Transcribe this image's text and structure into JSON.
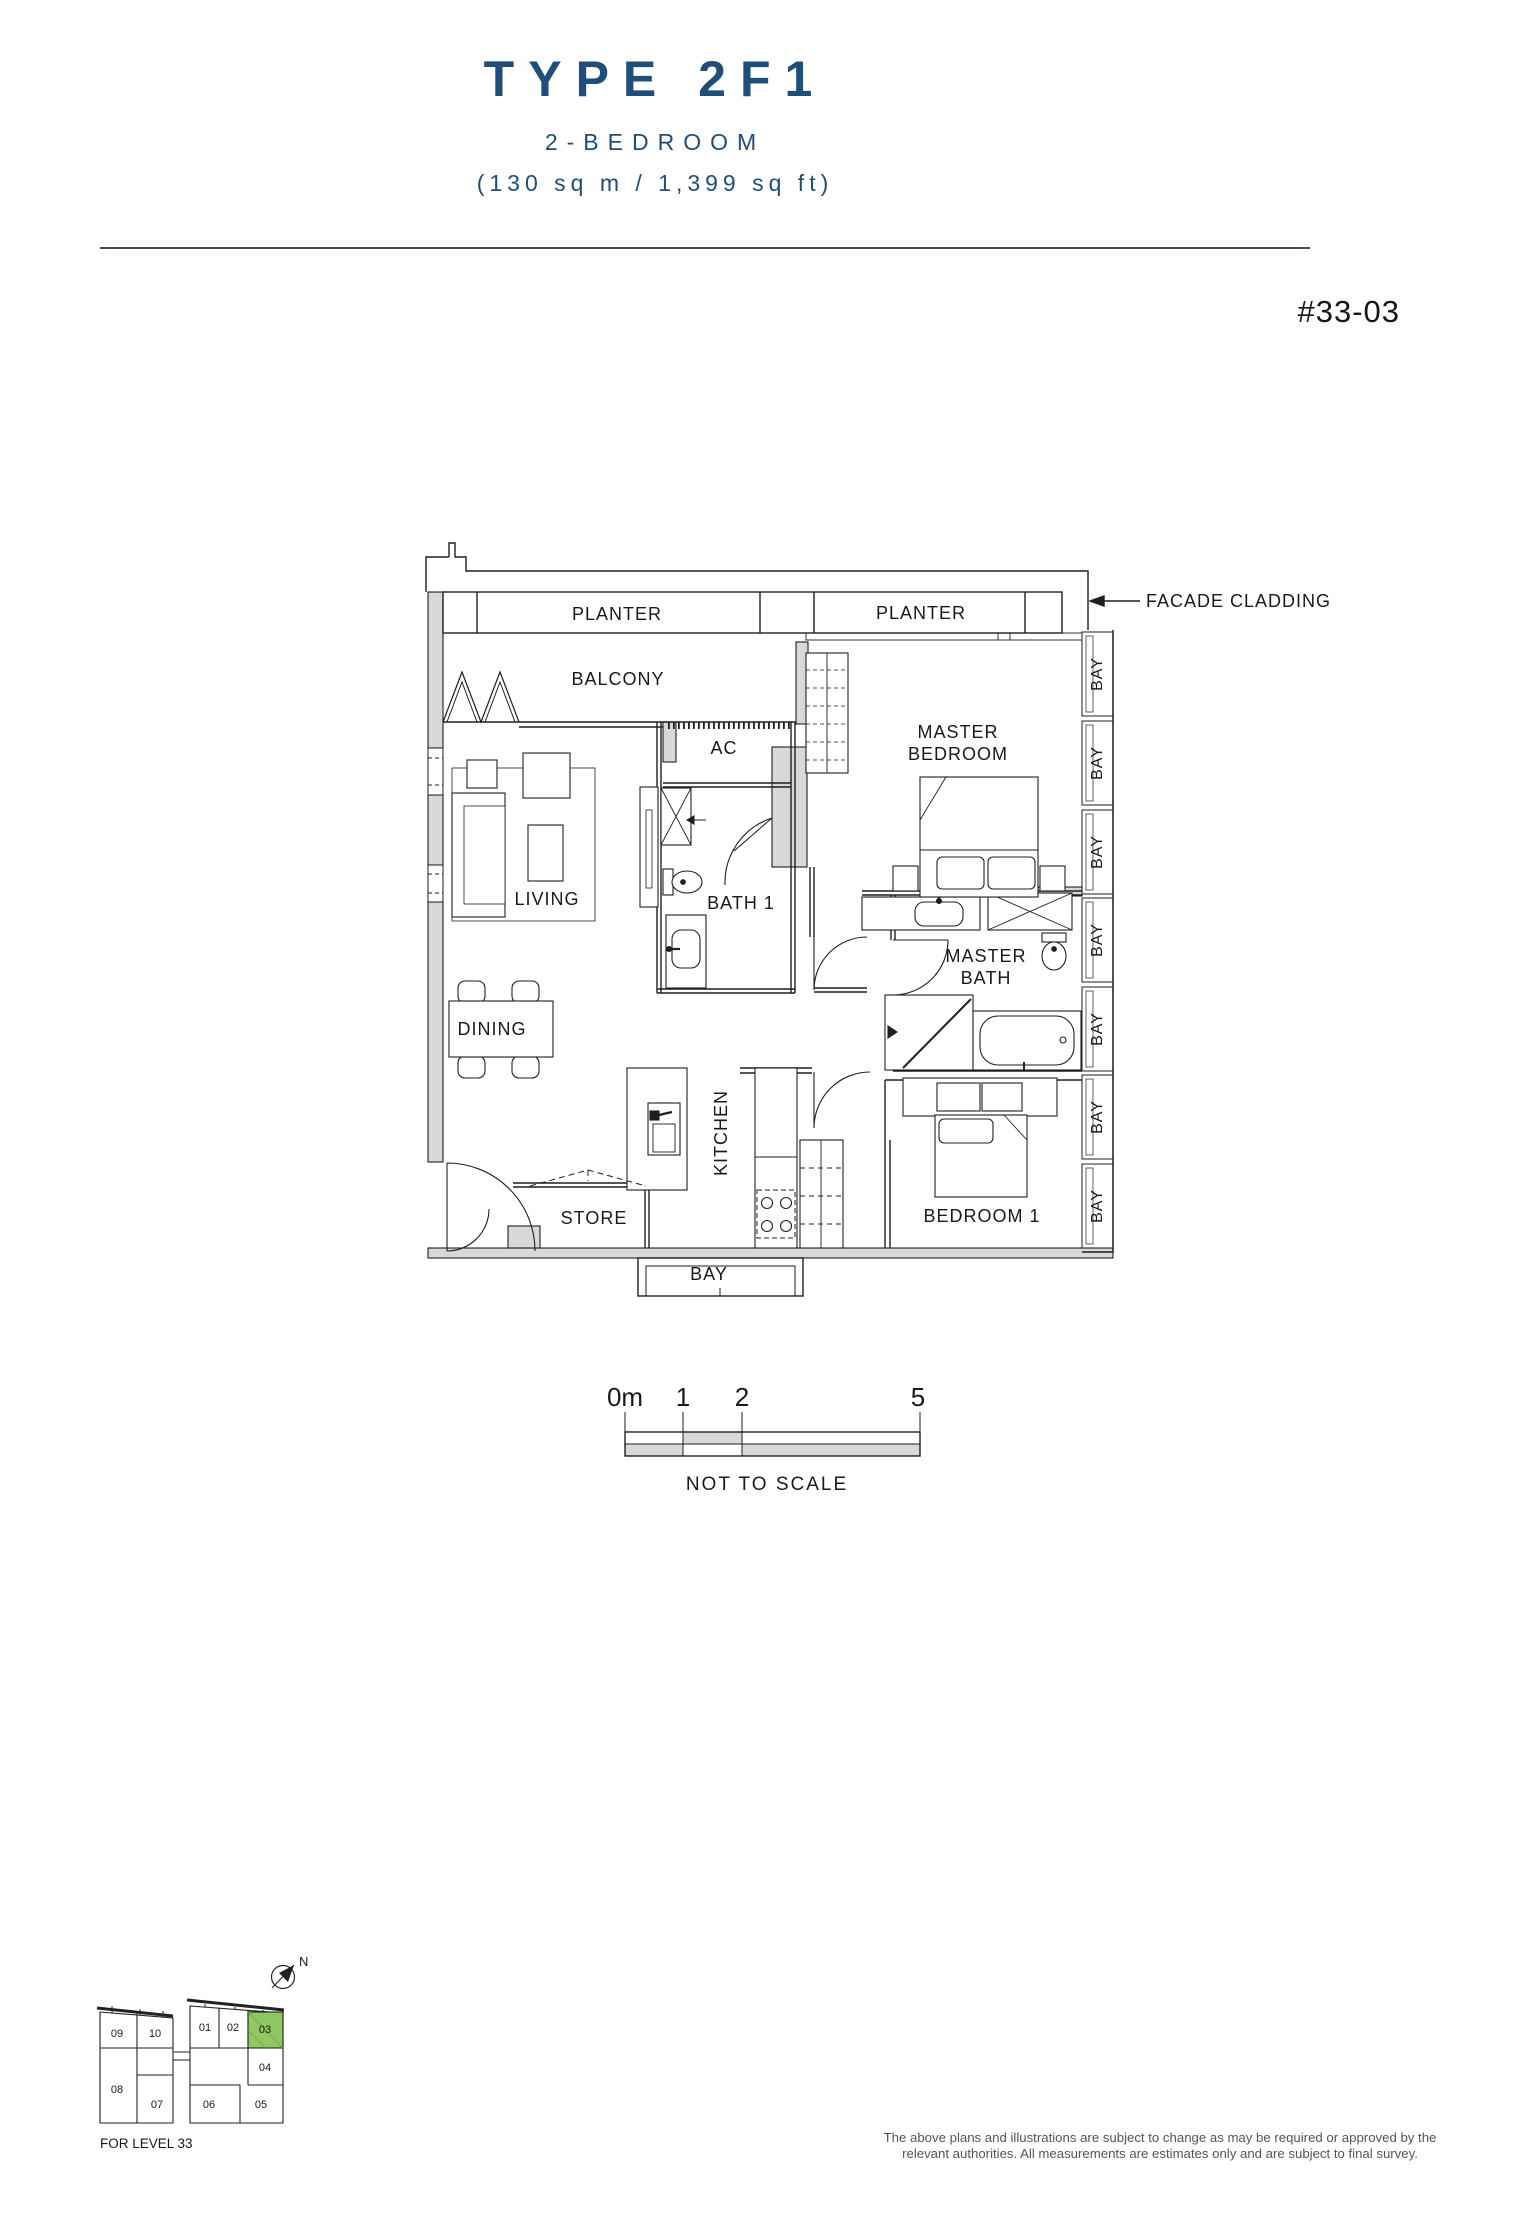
{
  "header": {
    "title": "TYPE 2F1",
    "subtitle": "2-BEDROOM",
    "area": "(130 sq m / 1,399 sq ft)",
    "unit_number": "#33-03"
  },
  "plan": {
    "labels": {
      "planter_left": "PLANTER",
      "planter_right": "PLANTER",
      "balcony": "BALCONY",
      "living": "LIVING",
      "dining": "DINING",
      "ac": "AC",
      "bath1": "BATH 1",
      "master_bedroom_line1": "MASTER",
      "master_bedroom_line2": "BEDROOM",
      "master_bath_line1": "MASTER",
      "master_bath_line2": "BATH",
      "kitchen": "KITCHEN",
      "store": "STORE",
      "bedroom1": "BEDROOM 1",
      "bay_window": "BAY",
      "facade_cladding": "FACADE CLADDING"
    },
    "bay_labels": [
      "BAY",
      "BAY",
      "BAY",
      "BAY",
      "BAY",
      "BAY",
      "BAY"
    ]
  },
  "scale_bar": {
    "tick_labels": [
      "0m",
      "1",
      "2",
      "5"
    ],
    "note": "NOT TO SCALE"
  },
  "key_plan": {
    "north_label": "N",
    "level_note": "FOR LEVEL 33",
    "highlighted_unit": "03",
    "highlight_color": "#8fc760",
    "units": [
      {
        "id": "09"
      },
      {
        "id": "10"
      },
      {
        "id": "08"
      },
      {
        "id": "07"
      },
      {
        "id": "01"
      },
      {
        "id": "02"
      },
      {
        "id": "03"
      },
      {
        "id": "04"
      },
      {
        "id": "05"
      },
      {
        "id": "06"
      }
    ]
  },
  "disclaimer": {
    "line1": "The above plans and illustrations are subject to change as may be required or approved by the",
    "line2": "relevant authorities. All measurements are estimates only and are subject to final survey."
  },
  "colors": {
    "accent": "#1f4e79",
    "line": "#1a1a1a",
    "wall_fill": "#d8d8d8",
    "highlight": "#8fc760"
  }
}
